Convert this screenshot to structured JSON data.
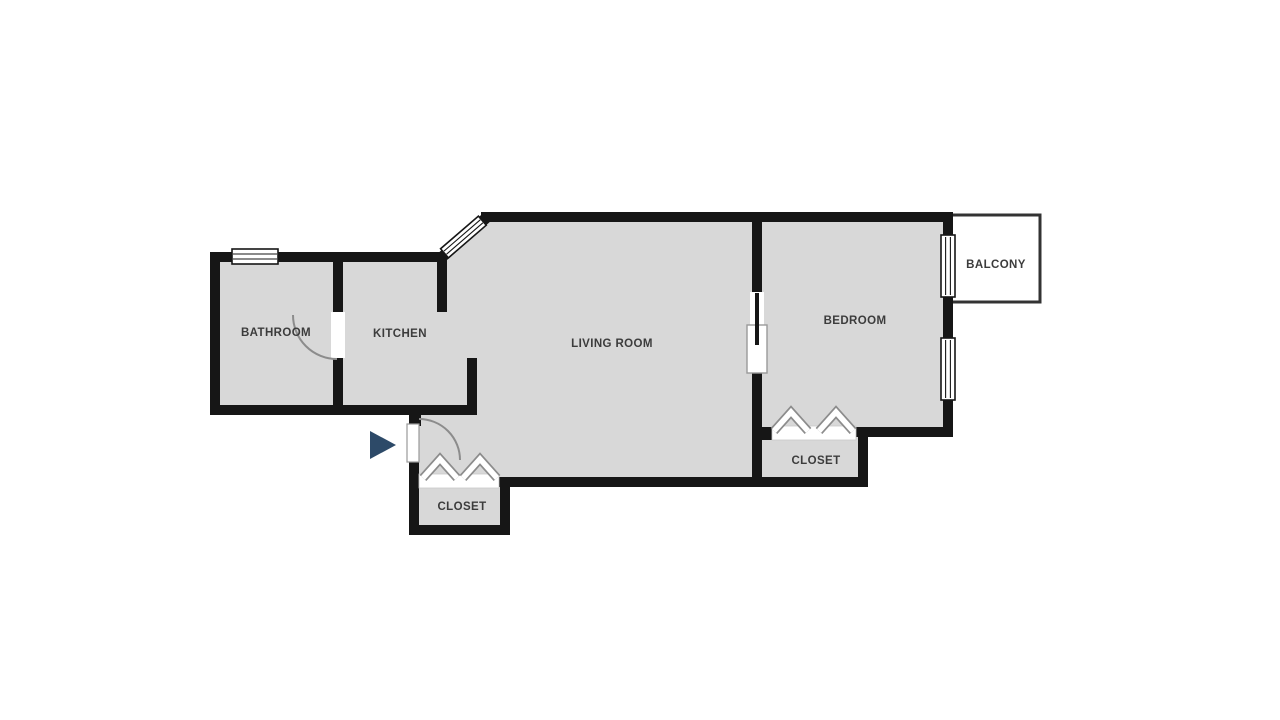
{
  "floor_plan": {
    "rooms": {
      "bathroom": {
        "label": "BATHROOM"
      },
      "kitchen": {
        "label": "KITCHEN"
      },
      "living_room": {
        "label": "LIVING ROOM"
      },
      "bedroom": {
        "label": "BEDROOM"
      },
      "balcony": {
        "label": "BALCONY"
      },
      "entry_closet": {
        "label": "CLOSET"
      },
      "bedroom_closet": {
        "label": "CLOSET"
      }
    },
    "icons": {
      "entrance_marker": "right-pointing-triangle",
      "closet_doors": "bifold-chevrons",
      "doors": "quarter-circle-swing-arc",
      "windows": "striped-rectangle"
    },
    "colors": {
      "background": "#ffffff",
      "wall": "#161616",
      "room_fill": "#d8d8d8",
      "door_arc": "#8c8c8c",
      "closet_symbol": "#8c8c8c",
      "balcony_border": "#333333",
      "entrance_marker": "#2d4a68",
      "label_text": "#3c3c3c"
    }
  }
}
